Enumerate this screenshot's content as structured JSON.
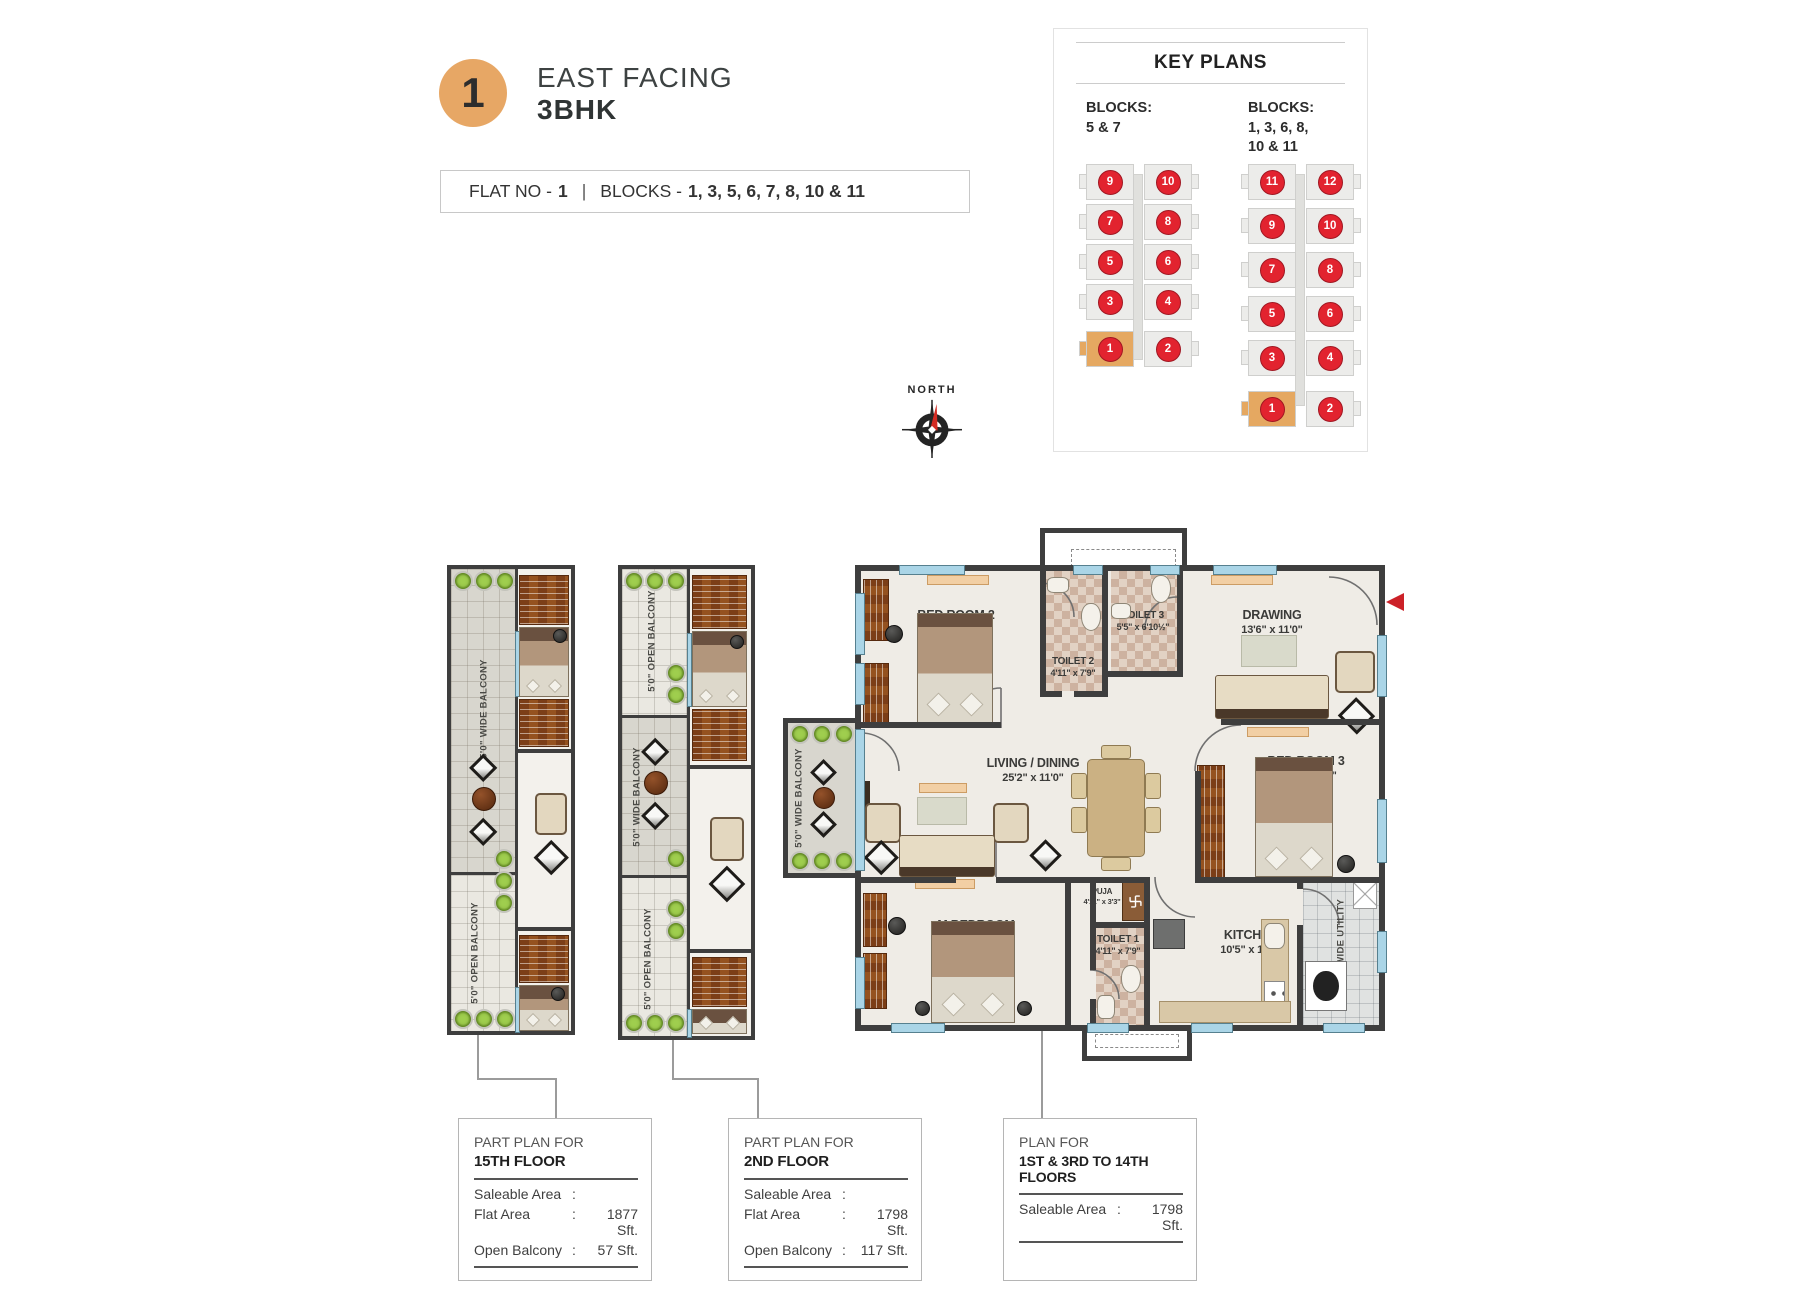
{
  "header": {
    "badge_number": "1",
    "facing": "EAST FACING",
    "type": "3BHK"
  },
  "flat_bar": {
    "flat_label": "FLAT NO -",
    "flat_no": "1",
    "divider": "|",
    "blocks_label": "BLOCKS -",
    "blocks": "1, 3, 5, 6, 7, 8, 10 & 11"
  },
  "key_plans": {
    "title": "KEY PLANS",
    "groups": [
      {
        "label": "BLOCKS:",
        "blocks": "5 & 7",
        "blocks2": "",
        "rows": [
          [
            "9",
            "10"
          ],
          [
            "7",
            "8"
          ],
          [
            "5",
            "6"
          ],
          [
            "3",
            "4"
          ],
          [
            "1",
            "2"
          ]
        ],
        "highlight": "1"
      },
      {
        "label": "BLOCKS:",
        "blocks": "1, 3, 6, 8,",
        "blocks2": "10 & 11",
        "rows": [
          [
            "11",
            "12"
          ],
          [
            "9",
            "10"
          ],
          [
            "7",
            "8"
          ],
          [
            "5",
            "6"
          ],
          [
            "3",
            "4"
          ],
          [
            "1",
            "2"
          ]
        ],
        "highlight": "1"
      }
    ]
  },
  "compass": {
    "label": "NORTH"
  },
  "part_plans": [
    {
      "sections": [
        {
          "label": "5'0\" WIDE BALCONY"
        },
        {
          "label": "5'0\" OPEN BALCONY"
        }
      ]
    },
    {
      "sections": [
        {
          "label": "5'0\" OPEN BALCONY"
        },
        {
          "label": "5'0\" WIDE BALCONY"
        },
        {
          "label": "5'0\" OPEN BALCONY"
        }
      ]
    }
  ],
  "main_plan": {
    "side_balcony_label": "5'0\" WIDE BALCONY",
    "utility_label": "5'2\" WIDE UTILITY",
    "rooms": [
      {
        "name": "BED ROOM 2",
        "size": "13'2\" x 11'0\""
      },
      {
        "name": "TOILET 2",
        "size": "4'11\" x 7'9\""
      },
      {
        "name": "TOILET 3",
        "size": "5'5\" x 6'10½\""
      },
      {
        "name": "DRAWING",
        "size": "13'6\" x 11'0\""
      },
      {
        "name": "LIVING / DINING",
        "size": "25'2\" x 11'0\""
      },
      {
        "name": "BED ROOM 3",
        "size": "12'6\" x 11'0\""
      },
      {
        "name": "M.BEDROOM",
        "size": "16'7\" x 11'0\""
      },
      {
        "name": "PUJA",
        "size": "4'11\" x 3'3\""
      },
      {
        "name": "TOILET 1",
        "size": "4'11\" x 7'9\""
      },
      {
        "name": "KITCHEN",
        "size": "10'5\" x 11'0\""
      }
    ]
  },
  "info_boxes": [
    {
      "title1": "PART PLAN FOR",
      "title2": "15TH FLOOR",
      "rows": [
        {
          "label": "Saleable Area",
          "colon": ":",
          "value": ""
        },
        {
          "label": "Flat Area",
          "colon": ":",
          "value": "1877 Sft."
        },
        {
          "label": "Open Balcony",
          "colon": ":",
          "value": "57 Sft."
        }
      ]
    },
    {
      "title1": "PART PLAN FOR",
      "title2": "2ND FLOOR",
      "rows": [
        {
          "label": "Saleable Area",
          "colon": ":",
          "value": ""
        },
        {
          "label": "Flat Area",
          "colon": ":",
          "value": "1798 Sft."
        },
        {
          "label": "Open Balcony",
          "colon": ":",
          "value": "117 Sft."
        }
      ]
    },
    {
      "title1": "PLAN FOR",
      "title2": "1ST & 3RD TO 14TH FLOORS",
      "rows": [
        {
          "label": "Saleable Area",
          "colon": ":",
          "value": "1798 Sft."
        }
      ]
    }
  ]
}
